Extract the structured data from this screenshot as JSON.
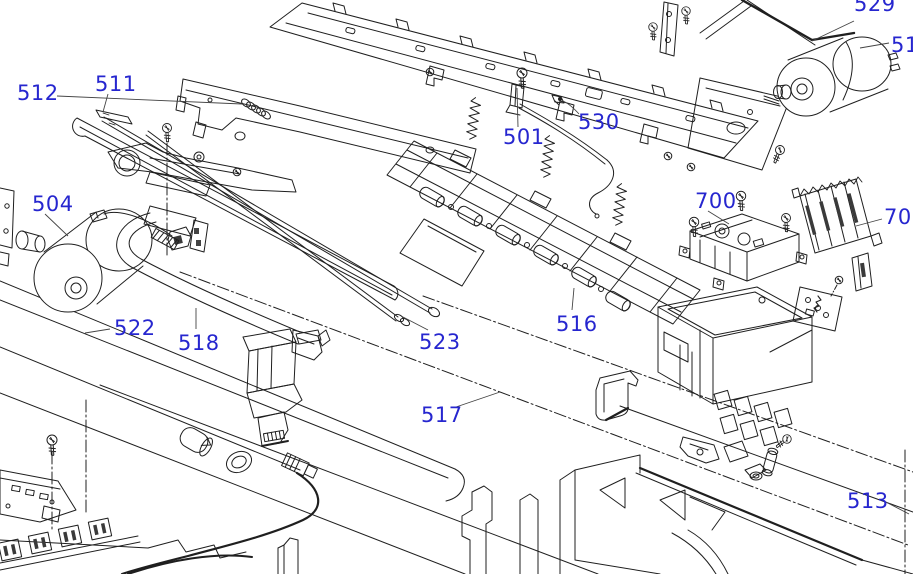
{
  "diagram": {
    "type": "exploded-parts-diagram",
    "label_color": "#2626cf",
    "line_color": "#1f1f1f",
    "background": "#ffffff",
    "labels": {
      "l512": "512",
      "l511": "511",
      "l529": "529",
      "l51x": "51",
      "l504": "504",
      "l501": "501",
      "l530": "530",
      "l700": "700",
      "l701": "701",
      "l522": "522",
      "l518": "518",
      "l523": "523",
      "l517": "517",
      "l516": "516",
      "l513": "513"
    }
  }
}
